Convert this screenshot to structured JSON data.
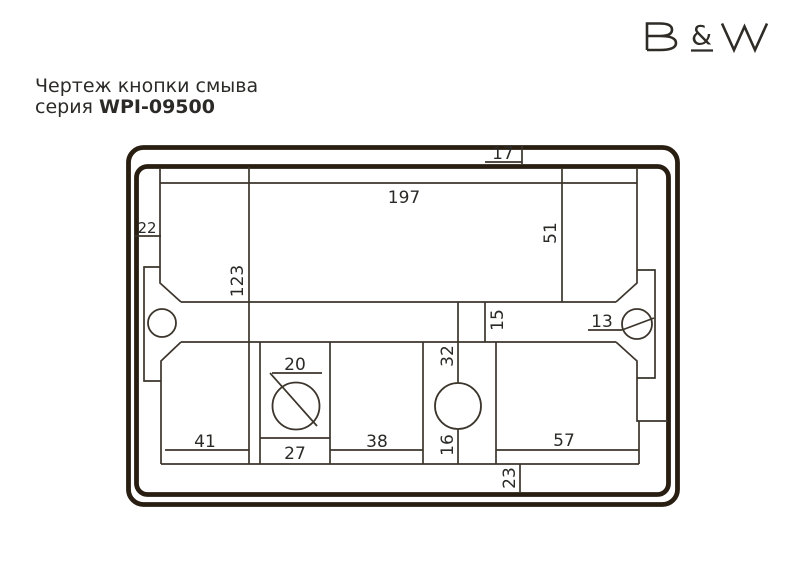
{
  "header": {
    "title": "Чертеж кнопки смыва",
    "series_prefix": "серия ",
    "series_code": "WPI-09500"
  },
  "logo": {
    "ampersand": "&"
  },
  "drawing": {
    "type": "technical-dimension-drawing",
    "subject": "flush-button-plate",
    "dims": {
      "top_frame_gap": "17",
      "top_plate_width": "197",
      "left_edge_inset": "22",
      "right_section_height": "51",
      "overall_inner_height": "123",
      "bar_height": "15",
      "right_hole_diameter": "13",
      "left_hole_diameter": "20",
      "center_strip_width": "32",
      "lower_left_box_width": "41",
      "button_strip_width": "27",
      "lower_middle_box_width": "38",
      "below_hole_segment": "16",
      "lower_right_box_width": "57",
      "bottom_frame_gap": "23"
    },
    "colors": {
      "background": "#ffffff",
      "frame": "#281e12",
      "line": "#3b352b",
      "text": "#2b2a27",
      "logo": "#2f2b26"
    }
  }
}
